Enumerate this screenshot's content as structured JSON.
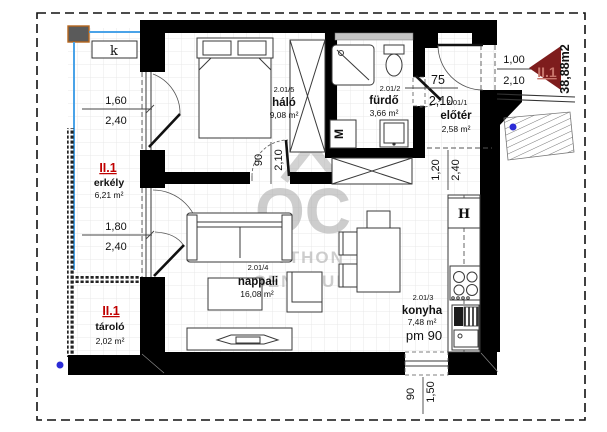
{
  "plan": {
    "unit_label": "II.1",
    "unit_total_area": "38,88m2",
    "corner_mark": "k",
    "rooms": {
      "halo": {
        "code": "2.01/5",
        "name": "háló",
        "area": "9,08 m²"
      },
      "furdo": {
        "code": "2.01/2",
        "name": "fürdő",
        "area": "3,66 m²"
      },
      "eloter": {
        "code": "2.01/1",
        "name": "előtér",
        "area": "2,58 m²"
      },
      "nappali": {
        "code": "2.01/4",
        "name": "nappali",
        "area": "16,08 m²"
      },
      "konyha": {
        "code": "2.01/3",
        "name": "konyha",
        "area": "7,48 m²",
        "parapet": "pm 90"
      },
      "erkely": {
        "unit": "II.1",
        "name": "erkély",
        "area": "6,21 m²"
      },
      "tarolo": {
        "unit": "II.1",
        "name": "tároló",
        "area": "2,02 m²"
      }
    },
    "appliances": {
      "washing_machine": "M",
      "fridge": "H"
    },
    "dimensions": {
      "bedroom_window_w": "1,60",
      "bedroom_window_h": "2,40",
      "living_window_w": "1,80",
      "living_window_h": "2,40",
      "entry_door_w": "1,00",
      "entry_door_h": "2,10",
      "bath_door_w": "75",
      "bath_door_h": "2,10",
      "bedroom_door_w": "90",
      "bedroom_door_h": "2,10",
      "passage_w": "1,20",
      "passage_h": "2,40",
      "kitchen_window_w": "90",
      "kitchen_window_h": "1,50"
    },
    "watermark": {
      "logo": "OC",
      "line1": "OTTHON",
      "line2": "CENTRUM"
    },
    "colors": {
      "wall": "#000000",
      "unit_red": "#c00000",
      "arrow_red": "#7e1d1d",
      "blue_marker": "#2b2bd6",
      "blue_line": "#4aa3e8",
      "watermark_gray": "#a6a6a6"
    }
  }
}
